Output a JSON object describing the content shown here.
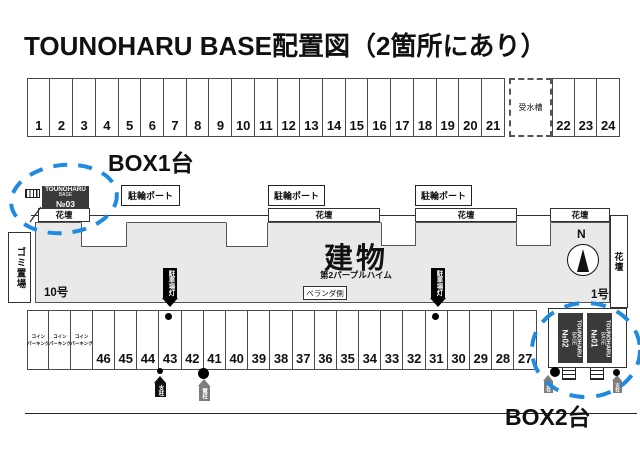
{
  "title": "TOUNOHARU BASE配置図（2箇所にあり）",
  "top_row": {
    "left_spaces": [
      "1",
      "2",
      "3",
      "4",
      "5",
      "6",
      "7",
      "8",
      "9",
      "10",
      "11",
      "12",
      "13",
      "14",
      "15",
      "16",
      "17",
      "18",
      "19",
      "20",
      "21"
    ],
    "water_tank_label": "受水槽",
    "right_spaces": [
      "22",
      "23",
      "24"
    ]
  },
  "box1": {
    "label": "BOX1台",
    "unit": {
      "l1": "TOUNOHARU",
      "l2": "BASE",
      "l3": "№03"
    }
  },
  "facilities": {
    "bike_port_label": "駐輪ポート",
    "flower_bed_label": "花壇",
    "garbage_label": "ゴミ置場"
  },
  "building": {
    "name": "建物",
    "subtitle": "第2パープルハイム",
    "veranda_label": "ベランダ側",
    "unit_left": "10号",
    "unit_right": "1号",
    "compass": "N",
    "parking_light_label": "駐車場灯"
  },
  "bottom_row": {
    "coin_cells": [
      [
        "コイン",
        "パーキング"
      ],
      [
        "コイン",
        "パーキング"
      ],
      [
        "コイン",
        "パーキング"
      ]
    ],
    "spaces": [
      "46",
      "45",
      "44",
      "43",
      "42",
      "41",
      "40",
      "39",
      "38",
      "37",
      "36",
      "35",
      "34",
      "33",
      "32",
      "31",
      "30",
      "29",
      "28",
      "27"
    ]
  },
  "markers": {
    "support_pole": "支柱",
    "utility_pole": "電柱"
  },
  "box2": {
    "label": "BOX2台",
    "unit_left": {
      "l1": "TOUNOHARU",
      "l2": "BASE",
      "l3": "№02"
    },
    "unit_right": {
      "l1": "TOUNOHARU",
      "l2": "BASE",
      "l3": "№01"
    }
  },
  "colors": {
    "accent_blue": "#1f8ae0",
    "dark_box": "#3a3a3a",
    "building_fill": "#e9e9e9"
  }
}
